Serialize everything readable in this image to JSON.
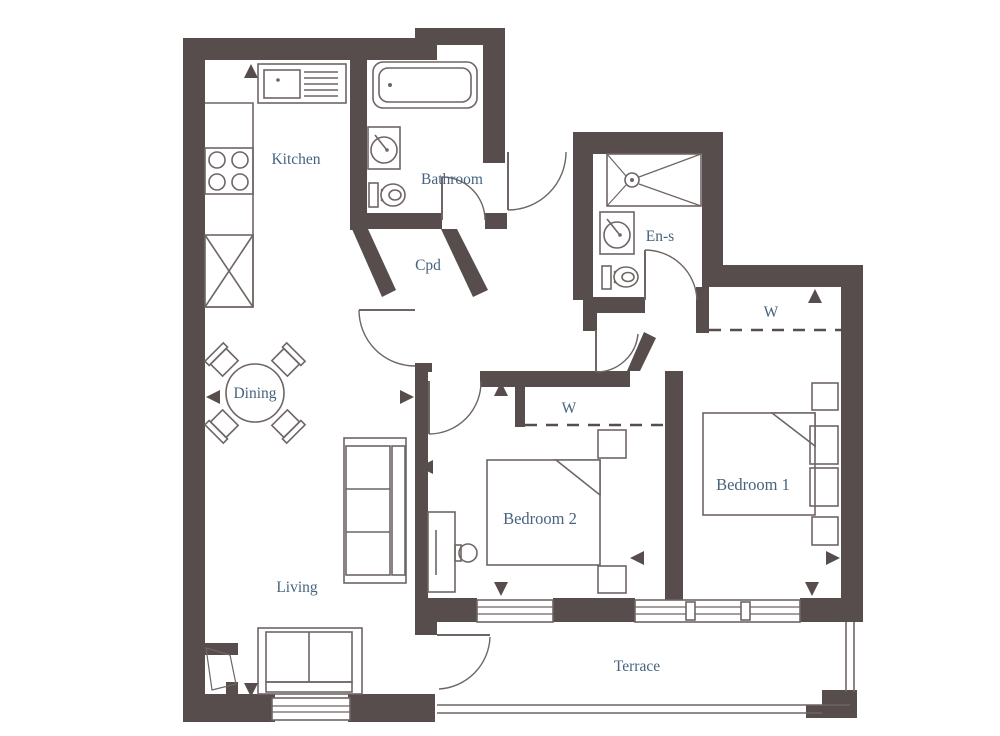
{
  "plan": {
    "type": "apartment-floor-plan",
    "rooms": [
      {
        "id": "kitchen",
        "label": "Kitchen"
      },
      {
        "id": "bathroom",
        "label": "Bathroom"
      },
      {
        "id": "cupboard",
        "label": "Cpd"
      },
      {
        "id": "en-suite",
        "label": "En-s"
      },
      {
        "id": "dining",
        "label": "Dining"
      },
      {
        "id": "living",
        "label": "Living"
      },
      {
        "id": "bedroom-1",
        "label": "Bedroom 1"
      },
      {
        "id": "bedroom-2",
        "label": "Bedroom 2"
      },
      {
        "id": "terrace",
        "label": "Terrace"
      },
      {
        "id": "wardrobe-bedroom-1",
        "label": "W"
      },
      {
        "id": "wardrobe-bedroom-2",
        "label": "W"
      }
    ],
    "colors": {
      "wall": "#574d4d",
      "line": "#6f6565",
      "label": "#47637d",
      "floor": "#ffffff"
    },
    "fixtures": [
      {
        "room": "kitchen",
        "items": [
          "sink-with-drainer",
          "hob-4-ring",
          "worktop",
          "tall-unit"
        ]
      },
      {
        "room": "bathroom",
        "items": [
          "bath",
          "washbasin",
          "toilet"
        ]
      },
      {
        "room": "en-suite",
        "items": [
          "shower",
          "washbasin",
          "toilet"
        ]
      },
      {
        "room": "dining",
        "items": [
          "round-table",
          "chair-x4"
        ]
      },
      {
        "room": "living",
        "items": [
          "sofa-3-seat",
          "sofa-2-seat"
        ]
      },
      {
        "room": "bedroom-1",
        "items": [
          "double-bed",
          "pillows",
          "bedside-table-x2",
          "wardrobe"
        ]
      },
      {
        "room": "bedroom-2",
        "items": [
          "double-bed",
          "bedside-table-x2",
          "desk",
          "desk-chair",
          "wardrobe"
        ]
      }
    ],
    "doors": [
      "entrance",
      "bathroom",
      "en-suite",
      "living",
      "bedroom-1",
      "bedroom-2",
      "terrace"
    ],
    "windows": [
      "living",
      "bedroom-2",
      "bedroom-1"
    ],
    "markers": [
      {
        "room": "kitchen",
        "direction": "up"
      },
      {
        "room": "dining",
        "direction": "left"
      },
      {
        "room": "living",
        "direction": "right"
      },
      {
        "room": "living",
        "direction": "down"
      },
      {
        "room": "bedroom-2",
        "direction": "up"
      },
      {
        "room": "bedroom-2",
        "direction": "left"
      },
      {
        "room": "bedroom-2",
        "direction": "down"
      },
      {
        "room": "bedroom-1",
        "direction": "left"
      },
      {
        "room": "bedroom-1",
        "direction": "right"
      },
      {
        "room": "bedroom-1",
        "direction": "down"
      },
      {
        "room": "wardrobe-bedroom-1",
        "direction": "up"
      }
    ]
  }
}
